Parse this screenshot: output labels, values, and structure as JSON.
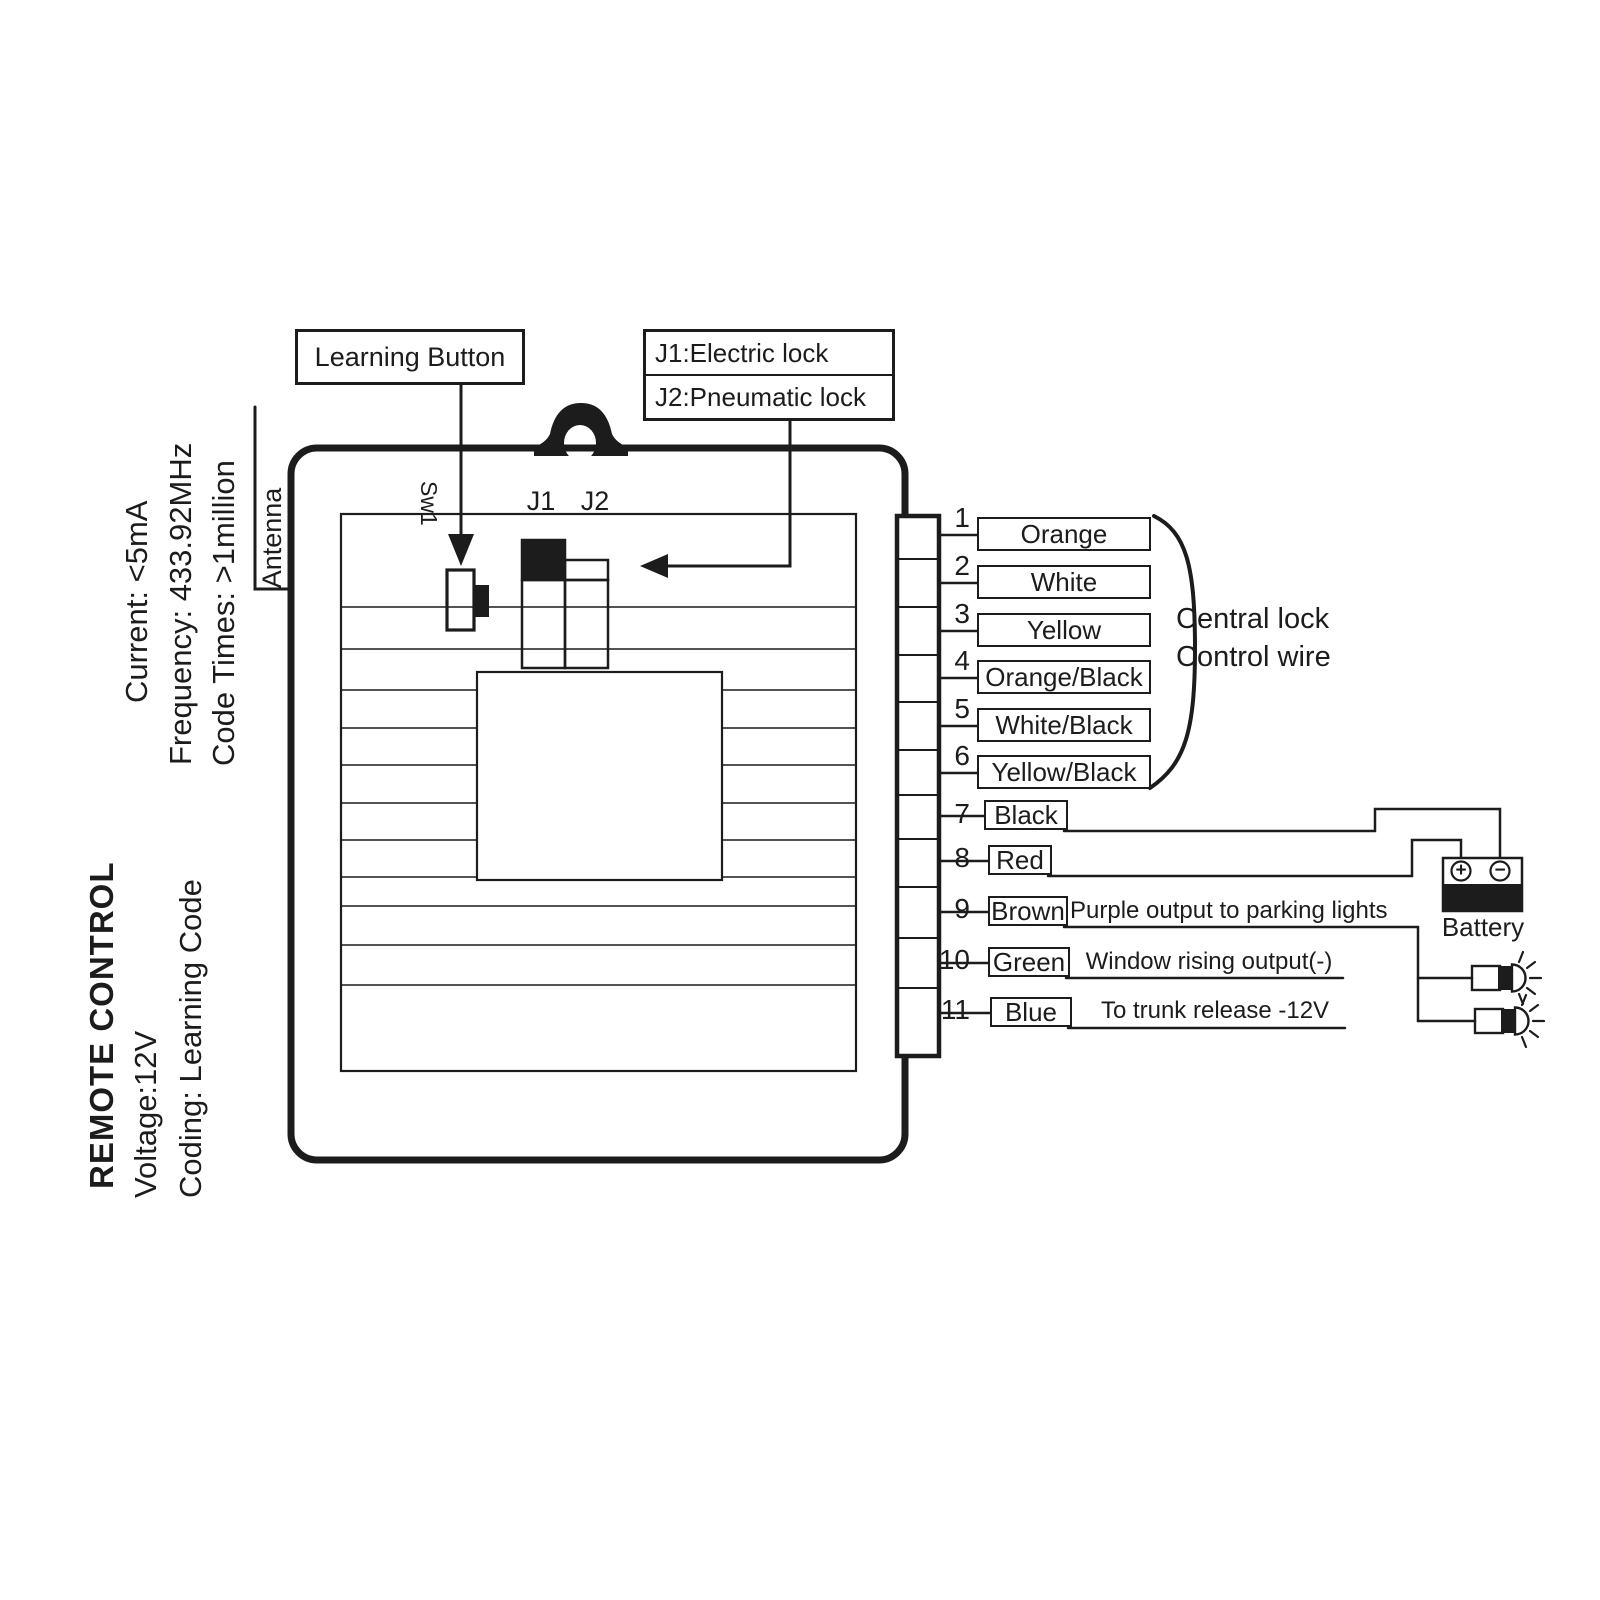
{
  "specs": {
    "current": "Current:  <5mA",
    "frequency": "Frequency: 433.92MHz",
    "code_times": "Code Times: >1million",
    "title": "REMOTE CONTROL",
    "voltage": "Voltage:12V",
    "coding": "Coding: Learning Code"
  },
  "unit": {
    "antenna_label": "Antenna",
    "switch_label": "Sw1",
    "jumper1_label": "J1",
    "jumper2_label": "J2"
  },
  "callouts": {
    "learning_button": "Learning Button",
    "jumper_line1": "J1:Electric lock",
    "jumper_line2": "J2:Pneumatic lock"
  },
  "wires": [
    {
      "num": "1",
      "color": "Orange",
      "note": ""
    },
    {
      "num": "2",
      "color": "White",
      "note": ""
    },
    {
      "num": "3",
      "color": "Yellow",
      "note": ""
    },
    {
      "num": "4",
      "color": "Orange/Black",
      "note": ""
    },
    {
      "num": "5",
      "color": "White/Black",
      "note": ""
    },
    {
      "num": "6",
      "color": "Yellow/Black",
      "note": ""
    },
    {
      "num": "7",
      "color": "Black",
      "note": ""
    },
    {
      "num": "8",
      "color": "Red",
      "note": ""
    },
    {
      "num": "9",
      "color": "Brown",
      "note": "Purple output to parking lights"
    },
    {
      "num": "10",
      "color": "Green",
      "note": "Window rising output(-)"
    },
    {
      "num": "11",
      "color": "Blue",
      "note": "To trunk release -12V"
    }
  ],
  "group": {
    "line1": "Central lock",
    "line2": "Control wire"
  },
  "battery": {
    "label": "Battery",
    "plus_symbol": "+",
    "minus_symbol": "−"
  },
  "colors": {
    "ink": "#1c1c1c",
    "paper": "#ffffff"
  }
}
